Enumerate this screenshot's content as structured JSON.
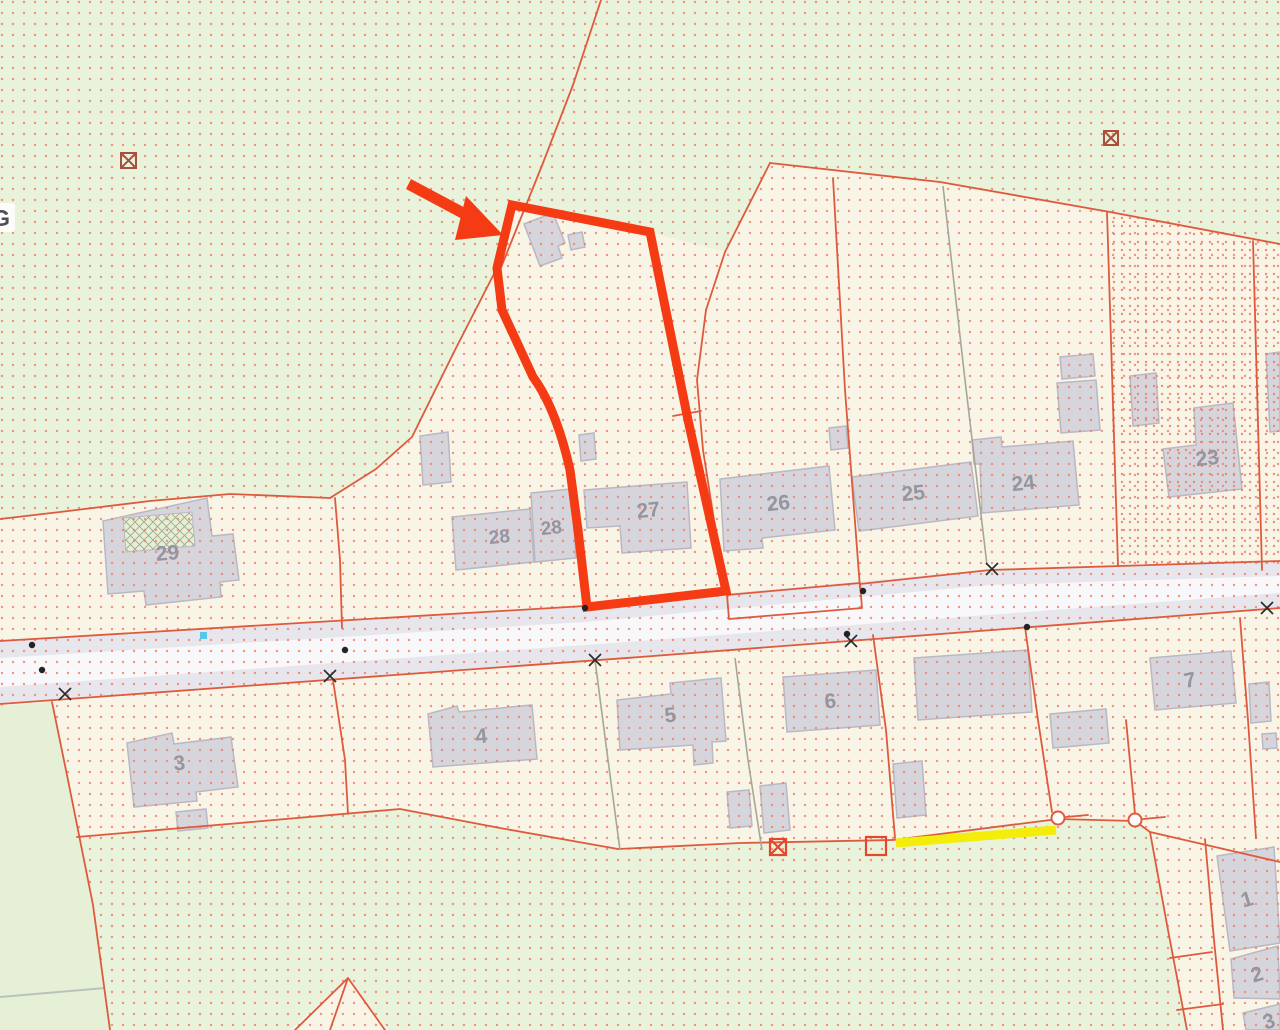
{
  "map": {
    "type": "cadastral-parcel-map",
    "labels": {
      "parcel_29": "29",
      "parcel_28a": "28",
      "parcel_28b": "28",
      "parcel_27": "27",
      "parcel_26": "26",
      "parcel_25": "25",
      "parcel_24": "24",
      "parcel_23": "23",
      "parcel_3": "3",
      "parcel_4": "4",
      "parcel_5": "5",
      "parcel_6": "6",
      "parcel_7": "7",
      "parcel_1": "1",
      "parcel_2": "2",
      "parcel_3b": "3",
      "street_name_partial": "G"
    }
  },
  "colors": {
    "cream": "#f8f5e6",
    "green": "#e9f2da",
    "plain_green": "#e6f0d7",
    "road": "#e7e6ec",
    "road_center": "#f8f8fb",
    "boundary_red": "#df5a3d",
    "gray_boundary": "#a6a69a",
    "highlight_red": "#f53b13",
    "yellow_marking": "#f4ec09",
    "cyan_marker": "#55c8e9",
    "building_gray": "#d6d5dc",
    "dot_pattern_red": "#ec8270",
    "label_gray": "#95949f"
  }
}
